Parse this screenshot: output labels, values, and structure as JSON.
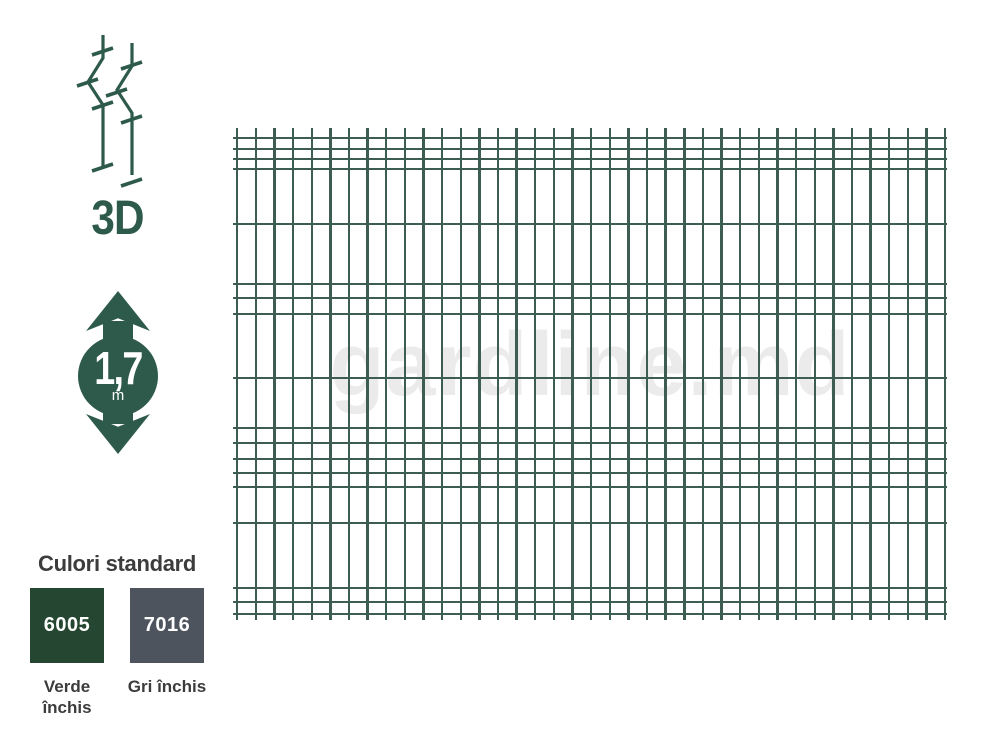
{
  "theme": {
    "background": "#ffffff",
    "accent_green": "#2d5a4a",
    "wire_green": "#3d5c52",
    "watermark_gray": "#ebebeb",
    "text_dark": "#3c3c3c"
  },
  "profile": {
    "label": "3D"
  },
  "height_indicator": {
    "value": "1,7",
    "unit": "m"
  },
  "colors_section": {
    "title": "Culori standard",
    "swatches": [
      {
        "code": "6005",
        "name": "Verde închis",
        "hex": "#254731"
      },
      {
        "code": "7016",
        "name": "Gri închis",
        "hex": "#4d545e"
      }
    ]
  },
  "fence_panel": {
    "watermark": "gardline.md",
    "vertical_wires": {
      "count": 39,
      "first_x": 3,
      "spacing": 18.63,
      "height": 492
    },
    "horizontal_wires_y": [
      9,
      20,
      30,
      40,
      95,
      155,
      169,
      185,
      249,
      299,
      314,
      330,
      344,
      358,
      394,
      459,
      473,
      485
    ]
  }
}
